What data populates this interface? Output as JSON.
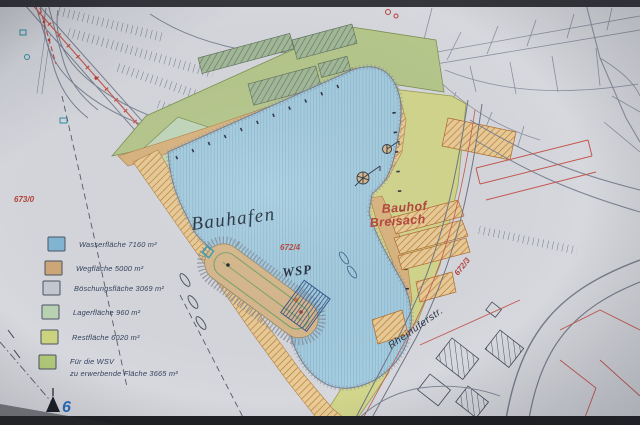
{
  "plan": {
    "labels": {
      "harbor_name": "Bauhafen",
      "wsp": "WSP",
      "bauhof_line1": "Bauhof",
      "bauhof_line2": "Breisach",
      "street_name": "Rheinuferstr.",
      "parcel_673_0": "673/0",
      "parcel_672_4": "672/4",
      "parcel_672_3": "672/3",
      "survey_point": "6"
    },
    "colors": {
      "paper": "#d6d8de",
      "water_fill": "#a6cde0",
      "path_fill": "#d9b47e",
      "green_zone_fill": "#b6c88c",
      "yellow_zone_fill": "#d2d68c",
      "lager_fill": "#c2d8bc",
      "red_line": "#c4584e",
      "red_label": "#b5423a"
    }
  },
  "legend": {
    "items": [
      {
        "label": "Wasserfläche 7160 m²",
        "color": "#82b7d4"
      },
      {
        "label": "Wegfläche 5000 m²",
        "color": "#cfa877"
      },
      {
        "label": "Böschungsfläche 3069 m²",
        "color": "#c6c8d2"
      },
      {
        "label": "Lagerfläche 960 m²",
        "color": "#b9d3b4"
      },
      {
        "label": "Restfläche 6020 m²",
        "color": "#ccd37f"
      },
      {
        "label": "Für die WSV",
        "label2": "zu erwerbende Fläche 3665 m²",
        "color": "#b3ca7a"
      }
    ]
  }
}
